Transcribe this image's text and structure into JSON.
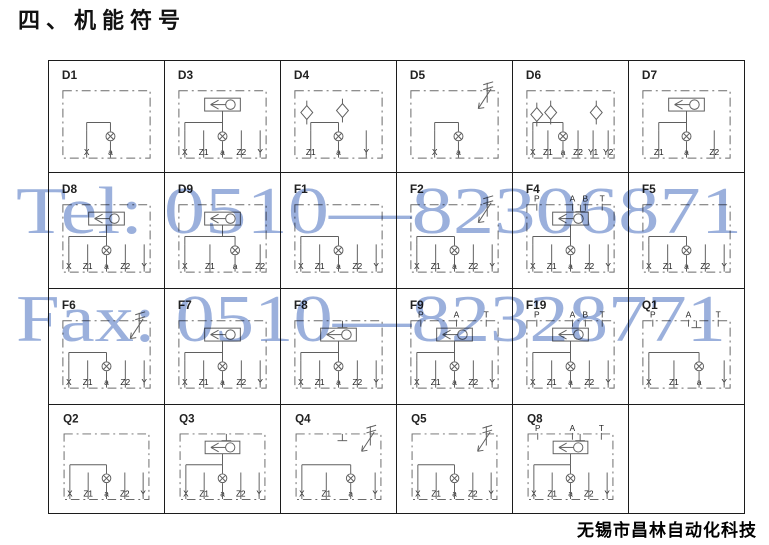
{
  "page": {
    "title": "四、机能符号",
    "footer": "无锡市昌林自动化科技"
  },
  "watermark": {
    "line1": "Tel: 0510—82306871",
    "line2": "Fax: 0510—82328771",
    "color": "#8aa3d6"
  },
  "diagram_style": {
    "line_color": "#5f5f5f",
    "label_color": "#222222",
    "border_color": "#1c1c1c"
  },
  "grid": {
    "columns": 6,
    "rows": 4,
    "cells": [
      {
        "id": "D1",
        "top_ports": [],
        "ports": [
          "X",
          "a"
        ],
        "valves": []
      },
      {
        "id": "D3",
        "top_ports": [],
        "ports": [
          "X",
          "Z1",
          "a",
          "Z2",
          "Y"
        ],
        "valves": [
          "shuttle"
        ]
      },
      {
        "id": "D4",
        "top_ports": [],
        "ports": [
          "Z1",
          "a",
          "Y"
        ],
        "valves": [
          "check",
          "check"
        ]
      },
      {
        "id": "D5",
        "top_ports": [],
        "ports": [
          "X",
          "a"
        ],
        "valves": [
          "relief"
        ]
      },
      {
        "id": "D6",
        "top_ports": [],
        "ports": [
          "X",
          "Z1",
          "a",
          "Z2",
          "Y1",
          "Y2"
        ],
        "valves": [
          "check",
          "check",
          "check"
        ]
      },
      {
        "id": "D7",
        "top_ports": [],
        "ports": [
          "Z1",
          "a",
          "Z2"
        ],
        "valves": [
          "shuttle"
        ]
      },
      {
        "id": "D8",
        "top_ports": [],
        "ports": [
          "X",
          "Z1",
          "a",
          "Z2",
          "Y"
        ],
        "valves": [
          "shuttle"
        ]
      },
      {
        "id": "D9",
        "top_ports": [],
        "ports": [
          "X",
          "Z1",
          "a",
          "Z2"
        ],
        "valves": [
          "shuttle"
        ]
      },
      {
        "id": "F1",
        "top_ports": [],
        "ports": [
          "X",
          "Z1",
          "a",
          "Z2",
          "Y"
        ],
        "valves": []
      },
      {
        "id": "F2",
        "top_ports": [],
        "ports": [
          "X",
          "Z1",
          "a",
          "Z2",
          "Y"
        ],
        "valves": [
          "relief"
        ]
      },
      {
        "id": "F4",
        "top_ports": [
          "P",
          "A",
          "B",
          "T"
        ],
        "ports": [
          "X",
          "Z1",
          "a",
          "Z2",
          "Y"
        ],
        "valves": [
          "shuttle",
          "plug"
        ]
      },
      {
        "id": "F5",
        "top_ports": [],
        "ports": [
          "X",
          "Z1",
          "a",
          "Z2",
          "Y"
        ],
        "valves": []
      },
      {
        "id": "F6",
        "top_ports": [],
        "ports": [
          "X",
          "Z1",
          "a",
          "Z2",
          "Y"
        ],
        "valves": [
          "relief"
        ]
      },
      {
        "id": "F7",
        "top_ports": [],
        "ports": [
          "X",
          "Z1",
          "a",
          "Z2",
          "Y"
        ],
        "valves": [
          "shuttle"
        ]
      },
      {
        "id": "F8",
        "top_ports": [],
        "ports": [
          "X",
          "Z1",
          "a",
          "Z2",
          "Y"
        ],
        "valves": [
          "shuttle",
          "plug"
        ]
      },
      {
        "id": "F9",
        "top_ports": [
          "P",
          "A",
          "T"
        ],
        "ports": [
          "X",
          "Z1",
          "a",
          "Z2",
          "Y"
        ],
        "valves": [
          "shuttle"
        ]
      },
      {
        "id": "F19",
        "top_ports": [
          "P",
          "A",
          "B",
          "T"
        ],
        "ports": [
          "X",
          "Z1",
          "a",
          "Z2",
          "Y"
        ],
        "valves": [
          "shuttle"
        ]
      },
      {
        "id": "Q1",
        "top_ports": [
          "P",
          "A",
          "T"
        ],
        "ports": [
          "X",
          "Z1",
          "a",
          "Y"
        ],
        "valves": [
          "plug"
        ]
      },
      {
        "id": "Q2",
        "top_ports": [],
        "ports": [
          "X",
          "Z1",
          "a",
          "Z2",
          "Y"
        ],
        "valves": []
      },
      {
        "id": "Q3",
        "top_ports": [],
        "ports": [
          "X",
          "Z1",
          "a",
          "Z2",
          "Y"
        ],
        "valves": [
          "shuttle",
          "plug"
        ]
      },
      {
        "id": "Q4",
        "top_ports": [],
        "ports": [
          "X",
          "Z1",
          "a",
          "Y"
        ],
        "valves": [
          "relief",
          "plug"
        ]
      },
      {
        "id": "Q5",
        "top_ports": [],
        "ports": [
          "X",
          "Z1",
          "a",
          "Z2",
          "Y"
        ],
        "valves": [
          "relief"
        ]
      },
      {
        "id": "Q8",
        "top_ports": [
          "P",
          "A",
          "T"
        ],
        "ports": [
          "X",
          "Z1",
          "a",
          "Z2",
          "Y"
        ],
        "valves": [
          "shuttle",
          "plug"
        ]
      },
      {
        "id": "",
        "top_ports": [],
        "ports": [],
        "valves": []
      }
    ]
  }
}
